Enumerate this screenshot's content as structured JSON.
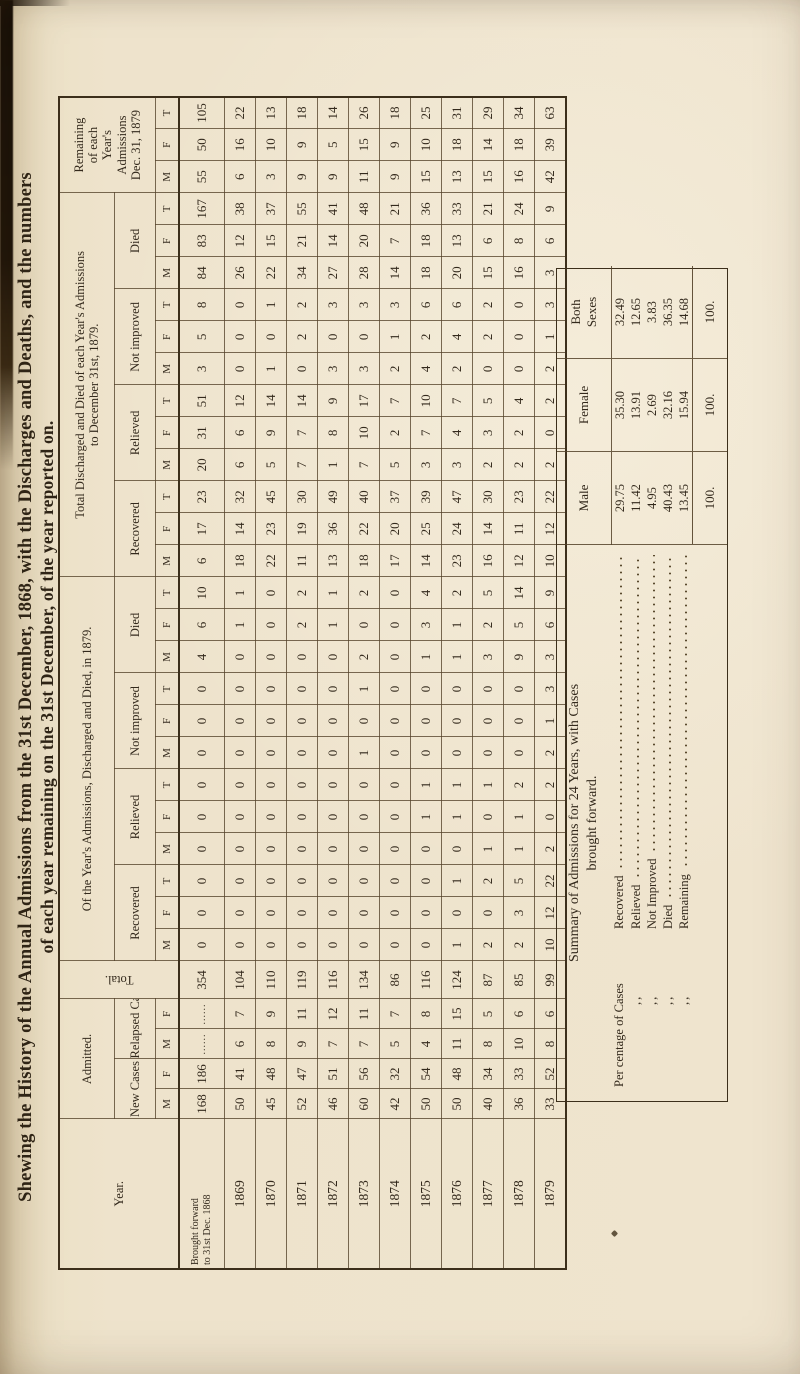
{
  "page": {
    "title_line1": "Shewing the History of the Annual Admissions from the 31st December, 1868, with the Discharges and Deaths, and the numbers",
    "title_line2": "of each year remaining on the 31st December, of the year reported on."
  },
  "table": {
    "headers": {
      "year": "Year.",
      "admitted": "Admitted.",
      "new_cases": "New Cases",
      "relapsed_cases": "Relapsed Cases",
      "total": "Total.",
      "in_1879": "Of the Year's Admissions, Discharged and Died, in 1879.",
      "to_date_line1": "Total Discharged and Died of each Year's Admissions",
      "to_date_line2": "to December 31st, 1879.",
      "remaining_lines": "Remaining\nof each\nYear's\nAdmissions\nDec. 31, 1879",
      "recovered": "Recovered",
      "relieved": "Relieved",
      "not_improved": "Not improved",
      "died": "Died",
      "m": "M",
      "f": "F",
      "t": "T"
    },
    "rows": [
      [
        "Brought forward|to 31st Dec. 1868",
        "168",
        "186",
        "......",
        "......",
        "354",
        "0",
        "0",
        "0",
        "0",
        "0",
        "0",
        "0",
        "0",
        "0",
        "4",
        "6",
        "10",
        "6",
        "17",
        "23",
        "20",
        "31",
        "51",
        "3",
        "5",
        "8",
        "84",
        "83",
        "167",
        "55",
        "50",
        "105"
      ],
      [
        "1869",
        "50",
        "41",
        "6",
        "7",
        "104",
        "0",
        "0",
        "0",
        "0",
        "0",
        "0",
        "0",
        "0",
        "0",
        "0",
        "1",
        "1",
        "18",
        "14",
        "32",
        "6",
        "6",
        "12",
        "0",
        "0",
        "0",
        "26",
        "12",
        "38",
        "6",
        "16",
        "22"
      ],
      [
        "1870",
        "45",
        "48",
        "8",
        "9",
        "110",
        "0",
        "0",
        "0",
        "0",
        "0",
        "0",
        "0",
        "0",
        "0",
        "0",
        "0",
        "0",
        "22",
        "23",
        "45",
        "5",
        "9",
        "14",
        "1",
        "0",
        "1",
        "22",
        "15",
        "37",
        "3",
        "10",
        "13"
      ],
      [
        "1871",
        "52",
        "47",
        "9",
        "11",
        "119",
        "0",
        "0",
        "0",
        "0",
        "0",
        "0",
        "0",
        "0",
        "0",
        "0",
        "2",
        "2",
        "11",
        "19",
        "30",
        "7",
        "7",
        "14",
        "0",
        "2",
        "2",
        "34",
        "21",
        "55",
        "9",
        "9",
        "18"
      ],
      [
        "1872",
        "46",
        "51",
        "7",
        "12",
        "116",
        "0",
        "0",
        "0",
        "0",
        "0",
        "0",
        "0",
        "0",
        "0",
        "0",
        "1",
        "1",
        "13",
        "36",
        "49",
        "1",
        "8",
        "9",
        "3",
        "0",
        "3",
        "27",
        "14",
        "41",
        "9",
        "5",
        "14"
      ],
      [
        "1873",
        "60",
        "56",
        "7",
        "11",
        "134",
        "0",
        "0",
        "0",
        "0",
        "0",
        "0",
        "1",
        "0",
        "1",
        "2",
        "0",
        "2",
        "18",
        "22",
        "40",
        "7",
        "10",
        "17",
        "3",
        "0",
        "3",
        "28",
        "20",
        "48",
        "11",
        "15",
        "26"
      ],
      [
        "1874",
        "42",
        "32",
        "5",
        "7",
        "86",
        "0",
        "0",
        "0",
        "0",
        "0",
        "0",
        "0",
        "0",
        "0",
        "0",
        "0",
        "0",
        "17",
        "20",
        "37",
        "5",
        "2",
        "7",
        "2",
        "1",
        "3",
        "14",
        "7",
        "21",
        "9",
        "9",
        "18"
      ],
      [
        "1875",
        "50",
        "54",
        "4",
        "8",
        "116",
        "0",
        "0",
        "0",
        "0",
        "1",
        "1",
        "0",
        "0",
        "0",
        "1",
        "3",
        "4",
        "14",
        "25",
        "39",
        "3",
        "7",
        "10",
        "4",
        "2",
        "6",
        "18",
        "18",
        "36",
        "15",
        "10",
        "25"
      ],
      [
        "1876",
        "50",
        "48",
        "11",
        "15",
        "124",
        "1",
        "0",
        "1",
        "0",
        "1",
        "1",
        "0",
        "0",
        "0",
        "1",
        "1",
        "2",
        "23",
        "24",
        "47",
        "3",
        "4",
        "7",
        "2",
        "4",
        "6",
        "20",
        "13",
        "33",
        "13",
        "18",
        "31"
      ],
      [
        "1877",
        "40",
        "34",
        "8",
        "5",
        "87",
        "2",
        "0",
        "2",
        "1",
        "0",
        "1",
        "0",
        "0",
        "0",
        "3",
        "2",
        "5",
        "16",
        "14",
        "30",
        "2",
        "3",
        "5",
        "0",
        "2",
        "2",
        "15",
        "6",
        "21",
        "15",
        "14",
        "29"
      ],
      [
        "1878",
        "36",
        "33",
        "10",
        "6",
        "85",
        "2",
        "3",
        "5",
        "1",
        "1",
        "2",
        "0",
        "0",
        "0",
        "9",
        "5",
        "14",
        "12",
        "11",
        "23",
        "2",
        "2",
        "4",
        "0",
        "0",
        "0",
        "16",
        "8",
        "24",
        "16",
        "18",
        "34"
      ],
      [
        "1879",
        "33",
        "52",
        "8",
        "6",
        "99",
        "10",
        "12",
        "22",
        "2",
        "0",
        "2",
        "2",
        "1",
        "3",
        "3",
        "6",
        "9",
        "10",
        "12",
        "22",
        "2",
        "0",
        "2",
        "2",
        "1",
        "3",
        "3",
        "6",
        "9",
        "42",
        "39",
        "63"
      ]
    ]
  },
  "summary": {
    "title_line1": "Summary of Admissions for 24 Years, with Cases",
    "title_line2": "brought forward.",
    "col_headers": {
      "male": "Male",
      "female": "Female",
      "both_line1": "Both",
      "both_line2": "Sexes"
    },
    "label_prefix": "Per centage of Cases",
    "ditto": ",,",
    "rows": [
      {
        "label": "Recovered",
        "male": "29.75",
        "female": "35.30",
        "both": "32.49"
      },
      {
        "label": "Relieved",
        "male": "11.42",
        "female": "13.91",
        "both": "12.65"
      },
      {
        "label": "Not Improved",
        "male": "4.95",
        "female": "2.69",
        "both": "3.83"
      },
      {
        "label": "Died",
        "male": "40.43",
        "female": "32.16",
        "both": "36.35"
      },
      {
        "label": "Remaining",
        "male": "13.45",
        "female": "15.94",
        "both": "14.68"
      }
    ],
    "totals": {
      "male": "100.",
      "female": "100.",
      "both": "100."
    }
  }
}
